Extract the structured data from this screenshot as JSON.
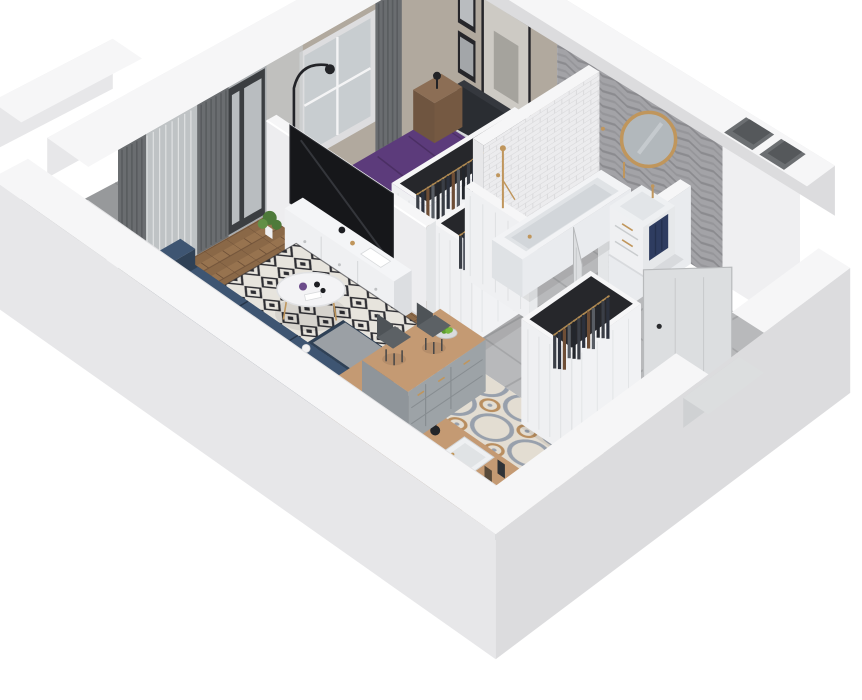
{
  "palette": {
    "bg": "#ffffff",
    "wallTop": "#f6f6f7",
    "wallSide": "#e7e7e9",
    "wallSideDark": "#dcdcde",
    "wallInner": "#efeff1",
    "beigeWall": "#b1a99e",
    "nicheDark": "#6c6f72",
    "nicheDeep": "#55585b",
    "glass": "#a7abae",
    "glassLight": "#b9bdc0",
    "frameDark": "#3b3e41",
    "curtainDark": "#6a6d70",
    "curtainDarker": "#595c5f",
    "curtainSheer": "#c6c9cb",
    "windowFrame": "#dddddf",
    "windowGlass": "#c8cdd0",
    "woodA": "#8a6847",
    "woodB": "#97734f",
    "woodC": "#6f5138",
    "rugBg": "#e7e4dd",
    "rugInk": "#2d2d32",
    "sofaNavy": "#2f4156",
    "sofaNavyLight": "#3e5572",
    "sofaNavyDark": "#263549",
    "pillowGray": "#aab0b5",
    "pillowLight": "#c7cbce",
    "pillowPurple": "#6b4b8a",
    "tableWhite": "#f3f3f5",
    "gold": "#c0965c",
    "tvBlack": "#16171a",
    "sideboardWhite": "#eff0f2",
    "sideboardShade": "#dcdee1",
    "bedPurple": "#5c3b7b",
    "bedPurpleDark": "#4b2f64",
    "sheetWhite": "#ced2d6",
    "pillowWhite": "#d9dbde",
    "headboard": "#35383e",
    "headboardDark": "#2a2d32",
    "nightWood": "#8c6e55",
    "nightWoodDark": "#755942",
    "balconyFloor": "#97999b",
    "railing": "#7e8184",
    "railingDark": "#606366",
    "chevBg": "#a3a3a7",
    "chevA": "#8b8b8f",
    "chevB": "#96969a",
    "subway": "#ececee",
    "subwayLine": "#d7d7d9",
    "tileGray": "#b8b9bb",
    "tileGrout": "#a4a5a7",
    "ornateBg": "#e3ddd2",
    "ornateBlue": "#98a0ac",
    "ornateTan": "#b98e5f",
    "counterWood": "#c49a73",
    "cabinetGray": "#9da3a7",
    "cabinetSeam": "#878d91",
    "cooktopBlack": "#191a1d",
    "sinkWhite": "#eef0f2",
    "steel": "#44464a",
    "clothes": [
      "#3a3e46",
      "#2c313d",
      "#6e4e36",
      "#585d64",
      "#23262c"
    ],
    "closetInner": "#26272b",
    "rail": "#b08a52",
    "towelNavy": "#2e3c60",
    "doorLeaf": "#dcdee0",
    "doorEdge": "#b8babc",
    "mirrorGlass": "#b2b8bc",
    "apple": "#76b83e",
    "appleDark": "#5e9a2f",
    "plantGreen": "#4e7a3a",
    "plantGreenLight": "#628f46"
  },
  "scene": {
    "rooms": [
      {
        "id": "living-room",
        "label": "Living room"
      },
      {
        "id": "bedroom",
        "label": "Bedroom"
      },
      {
        "id": "wardrobe-corridor",
        "label": "Wardrobe corridor"
      },
      {
        "id": "bathroom",
        "label": "Bathroom"
      },
      {
        "id": "hallway",
        "label": "Hallway"
      },
      {
        "id": "kitchen",
        "label": "Kitchen"
      },
      {
        "id": "balcony",
        "label": "Balcony"
      }
    ],
    "objects": [
      {
        "id": "balcony",
        "label": "balcony with railing"
      },
      {
        "id": "nw-wall",
        "label": "window wall with curtains and balcony door"
      },
      {
        "id": "ne-wall",
        "label": "bedroom wall with pictures, chevron bathroom wall, shaft niche"
      },
      {
        "id": "floors",
        "label": "wood, tile and patterned floors"
      },
      {
        "id": "bed-area",
        "label": "purple double bed with nightstands"
      },
      {
        "id": "closet-a",
        "label": "wardrobe rack with clothes (bedroom side)"
      },
      {
        "id": "closet-b",
        "label": "wardrobe rack with clothes (corridor side)"
      },
      {
        "id": "bathroom",
        "label": "bathtub, vanity, mirror, towel, door"
      },
      {
        "id": "tv-partition-media",
        "label": "TV partition and sideboard"
      },
      {
        "id": "living-area",
        "label": "sofa, rug, coffee table"
      },
      {
        "id": "kitchen",
        "label": "kitchen counters, cooktop, sink, dining peninsula"
      },
      {
        "id": "hall-closet",
        "label": "entry wardrobe rack"
      },
      {
        "id": "entry-door",
        "label": "entrance door"
      },
      {
        "id": "sw-wall",
        "label": "front-left cut wall"
      },
      {
        "id": "se-wall",
        "label": "front-right cut wall"
      }
    ]
  }
}
